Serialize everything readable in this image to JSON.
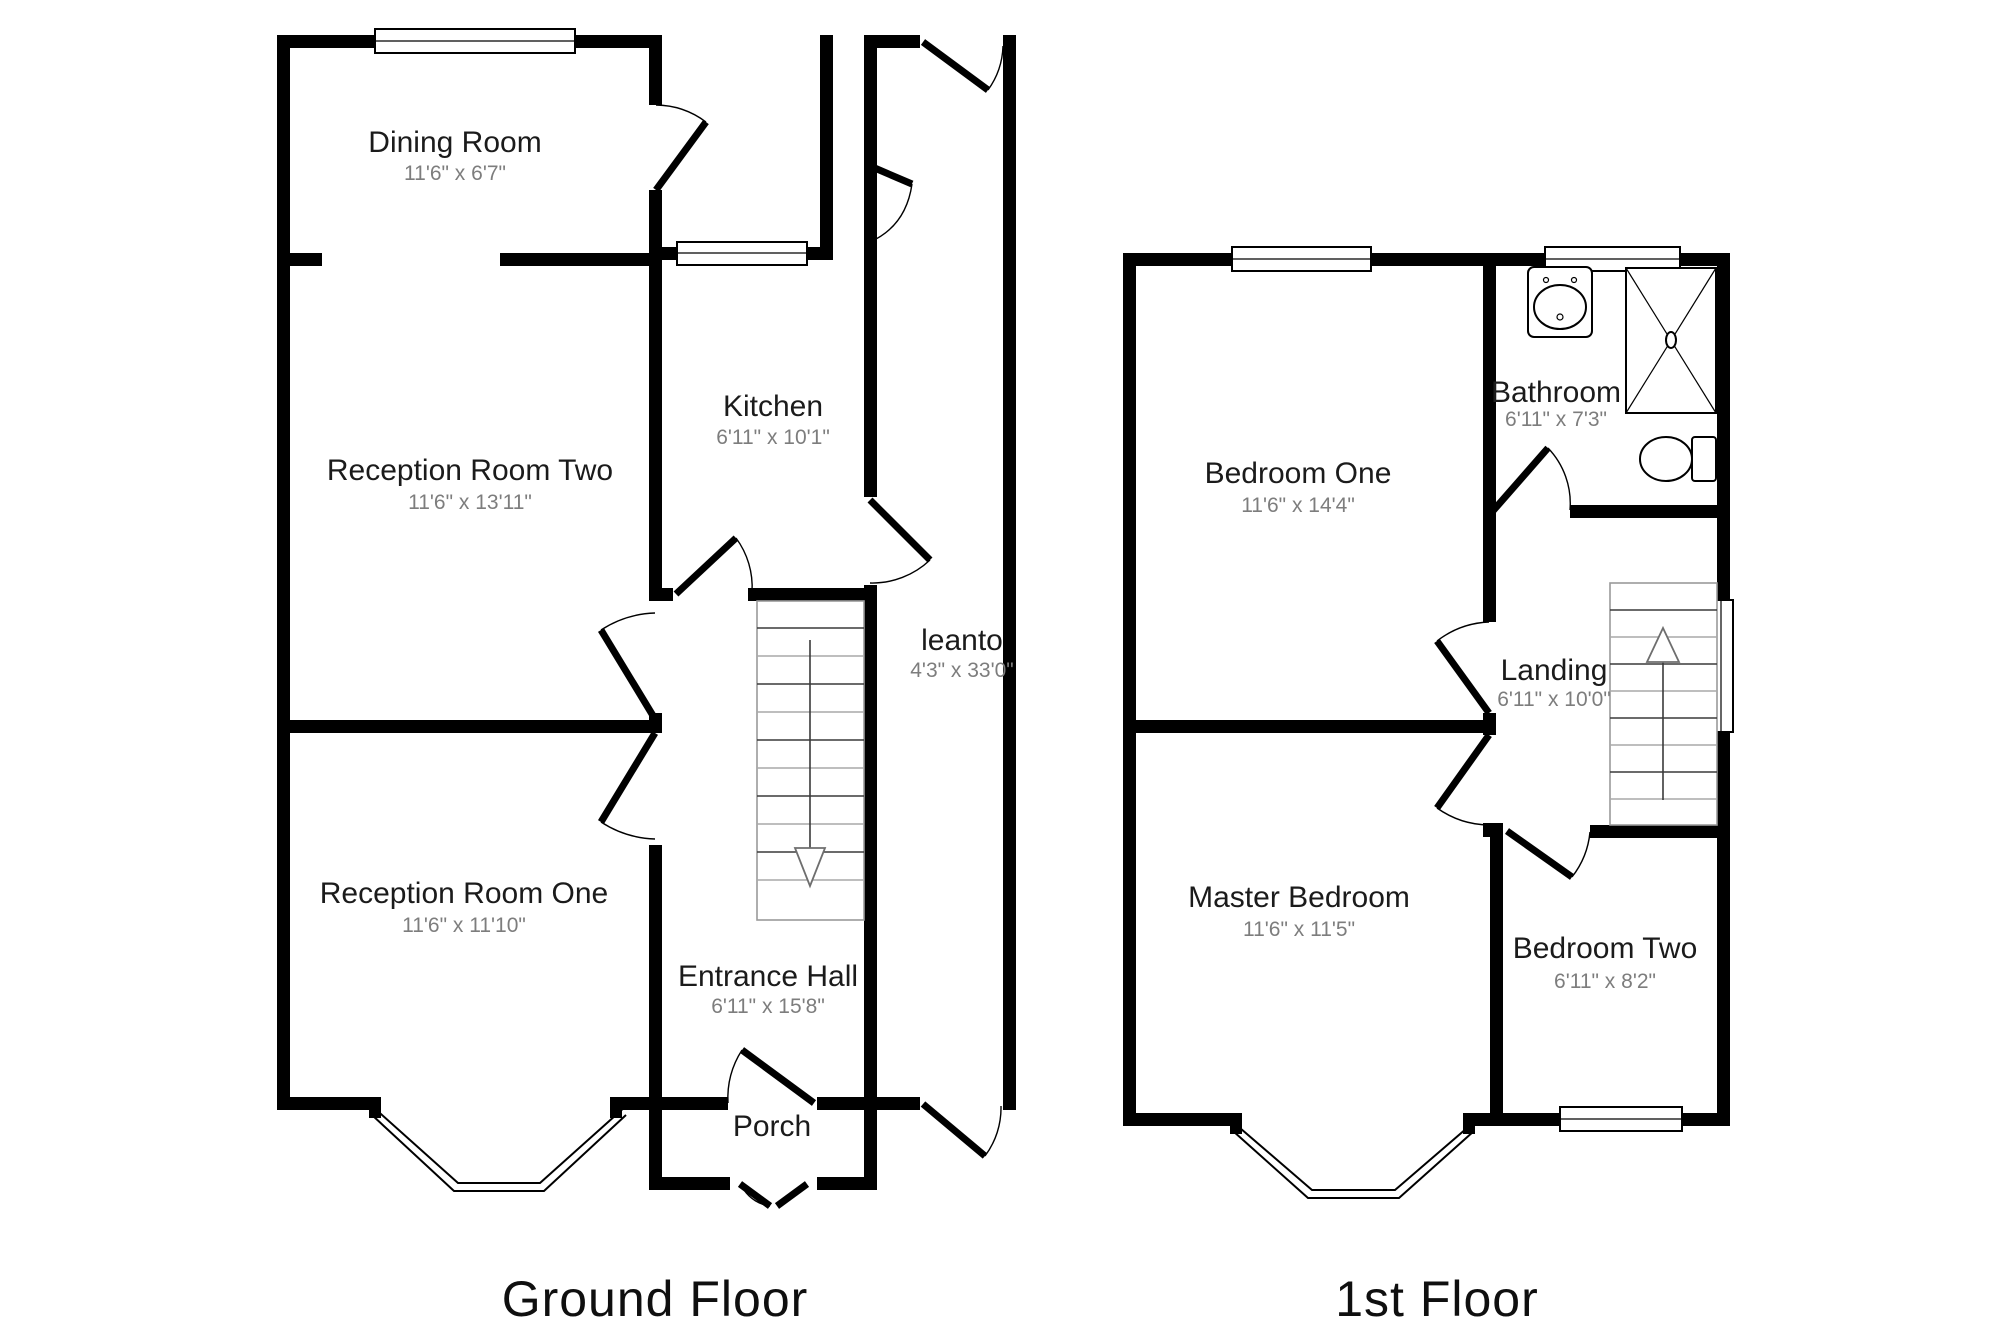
{
  "ground": {
    "title": "Ground Floor",
    "rooms": {
      "dining": {
        "name": "Dining Room",
        "dims": "11'6\" x 6'7\""
      },
      "reception2": {
        "name": "Reception Room Two",
        "dims": "11'6\" x 13'11\""
      },
      "kitchen": {
        "name": "Kitchen",
        "dims": "6'11\" x 10'1\""
      },
      "leanto": {
        "name": "leanto",
        "dims": "4'3\" x 33'0\""
      },
      "reception1": {
        "name": "Reception Room One",
        "dims": "11'6\" x 11'10\""
      },
      "hall": {
        "name": "Entrance Hall",
        "dims": "6'11\" x 15'8\""
      },
      "porch": {
        "name": "Porch"
      }
    }
  },
  "first": {
    "title": "1st Floor",
    "rooms": {
      "bedroom1": {
        "name": "Bedroom One",
        "dims": "11'6\" x 14'4\""
      },
      "bathroom": {
        "name": "Bathroom",
        "dims": "6'11\" x 7'3\""
      },
      "landing": {
        "name": "Landing",
        "dims": "6'11\" x 10'0\""
      },
      "master": {
        "name": "Master Bedroom",
        "dims": "11'6\" x 11'5\""
      },
      "bedroom2": {
        "name": "Bedroom Two",
        "dims": "6'11\" x 8'2\""
      }
    }
  },
  "colors": {
    "wall": "#000000",
    "room_name": "#1b1b1b",
    "dims": "#7d7d7d",
    "background": "#ffffff"
  }
}
